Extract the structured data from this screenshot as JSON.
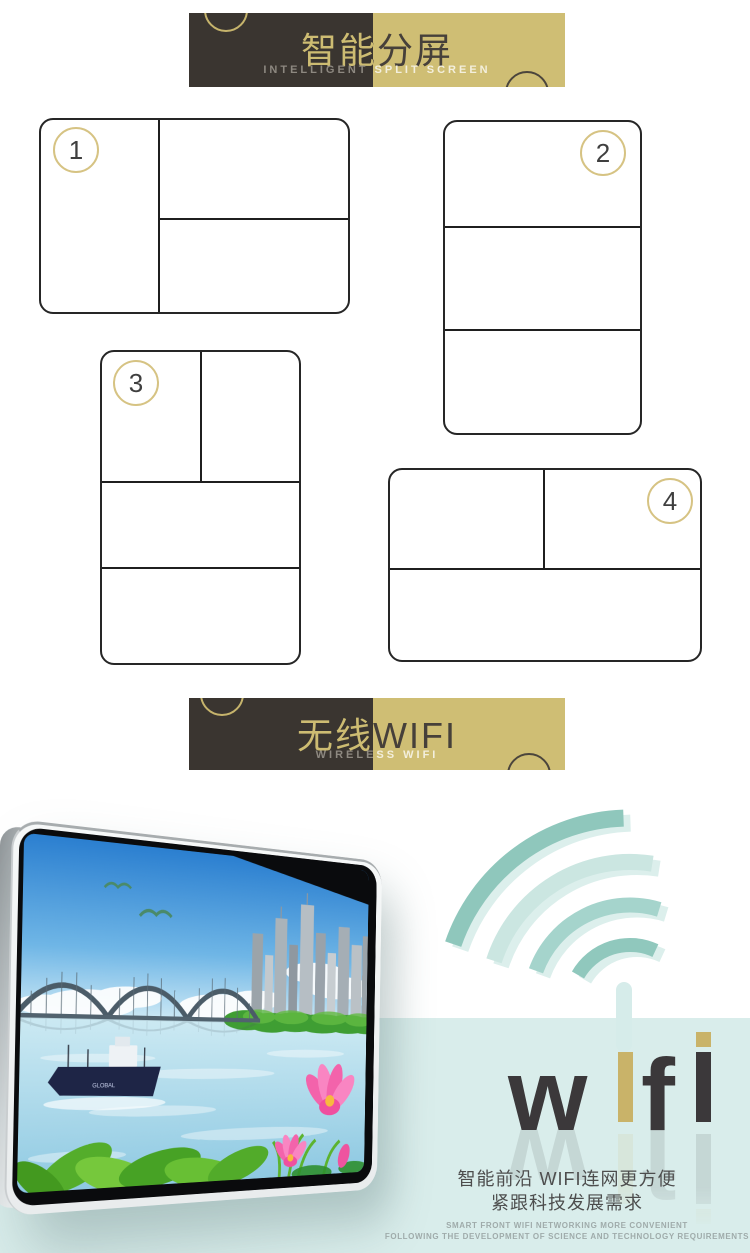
{
  "banners": [
    {
      "id": "split-screen",
      "title": "智能分屏",
      "subtitle": "INTELLIGENT SPLIT SCREEN"
    },
    {
      "id": "wireless-wifi",
      "title": "无线WIFI",
      "subtitle": "WIRELESS WIFI"
    }
  ],
  "split_layouts": [
    {
      "number": "1"
    },
    {
      "number": "2"
    },
    {
      "number": "3"
    },
    {
      "number": "4"
    }
  ],
  "monitor": {
    "ship_label": "GLOBAL",
    "screen_description": "landscape scene: blue sky with seagulls, arch bridge, city skyline, lake with cargo ship, green leaves and pink lotus flowers"
  },
  "wifi_logo": {
    "text": "wifi",
    "letters": [
      "w",
      "i",
      "f",
      "i"
    ]
  },
  "taglines": {
    "line1": "智能前沿 WIFI连网更方便",
    "line2": "紧跟科技发展需求",
    "small_line1": "SMART FRONT WIFI NETWORKING MORE CONVENIENT",
    "small_line2": "FOLLOWING THE DEVELOPMENT OF SCIENCE AND TECHNOLOGY REQUIREMENTS"
  },
  "colors": {
    "banner_dark": "#3a3530",
    "banner_gold": "#cfbe74",
    "accent_gold": "#c9b369",
    "teal_band": "#d9edeb",
    "wifi_arc_teal": "#8fc7bc",
    "logo_dark": "#3b383a"
  }
}
